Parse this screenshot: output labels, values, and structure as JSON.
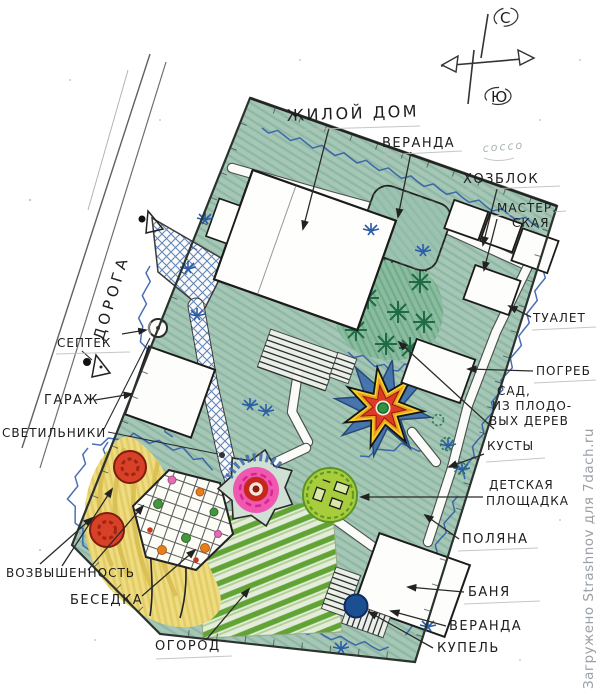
{
  "labels": {
    "house": "ЖИЛОЙ ДОМ",
    "house_veranda": "ВЕРАНДА",
    "utility_block": "ХОЗБЛОК",
    "workshop_line1": "МАСТЕР.",
    "workshop_line2": "СКАЯ",
    "toilet": "ТУАЛЕТ",
    "cellar": "ПОГРЕБ",
    "orchard_line1": "САД,",
    "orchard_line2": "ИЗ ПЛОДО-",
    "orchard_line3": "ВЫХ ДЕРЕВ",
    "bushes": "КУСТЫ",
    "playground_line1": "ДЕТСКАЯ",
    "playground_line2": "ПЛОЩАДКА",
    "glade": "ПОЛЯНА",
    "bathhouse": "БАНЯ",
    "bath_veranda": "ВЕРАНДА",
    "plunge_pool": "КУПЕЛЬ",
    "vegetable_garden": "ОГОРОД",
    "gazebo": "БЕСЕДКА",
    "hill": "ВОЗВЫШЕННОСТЬ",
    "lamps": "СВЕТИЛЬНИКИ",
    "garage": "ГАРАЖ",
    "septic": "СЕПТЕК",
    "road": "ДОРОГА"
  },
  "compass": {
    "north_label": "С",
    "south_label": "Ю"
  },
  "pencil_note": "соссо",
  "watermark": {
    "text": "Загружено Strashnov для 7dach.ru",
    "color": "#9aa0a6"
  },
  "colors": {
    "plot_green": "#a6c7b6",
    "orchard_green": "#8abd9e",
    "tree_green": "#1e6b45",
    "wave_blue": "#2b57a8",
    "star_blue": "#3f6fae",
    "star_yellow": "#f3d32b",
    "star_orange": "#ef9d1f",
    "star_red": "#de3b24",
    "star_center_green": "#2e9440",
    "playground_green": "#a8cd3c",
    "flower_pink": "#ef57b0",
    "flower_red_ring": "#c5271d",
    "hill_yellow": "#eedd80",
    "hill_tree_red": "#d84127",
    "pool_blue": "#1c4e92",
    "rows_green": "#5ea32f"
  }
}
